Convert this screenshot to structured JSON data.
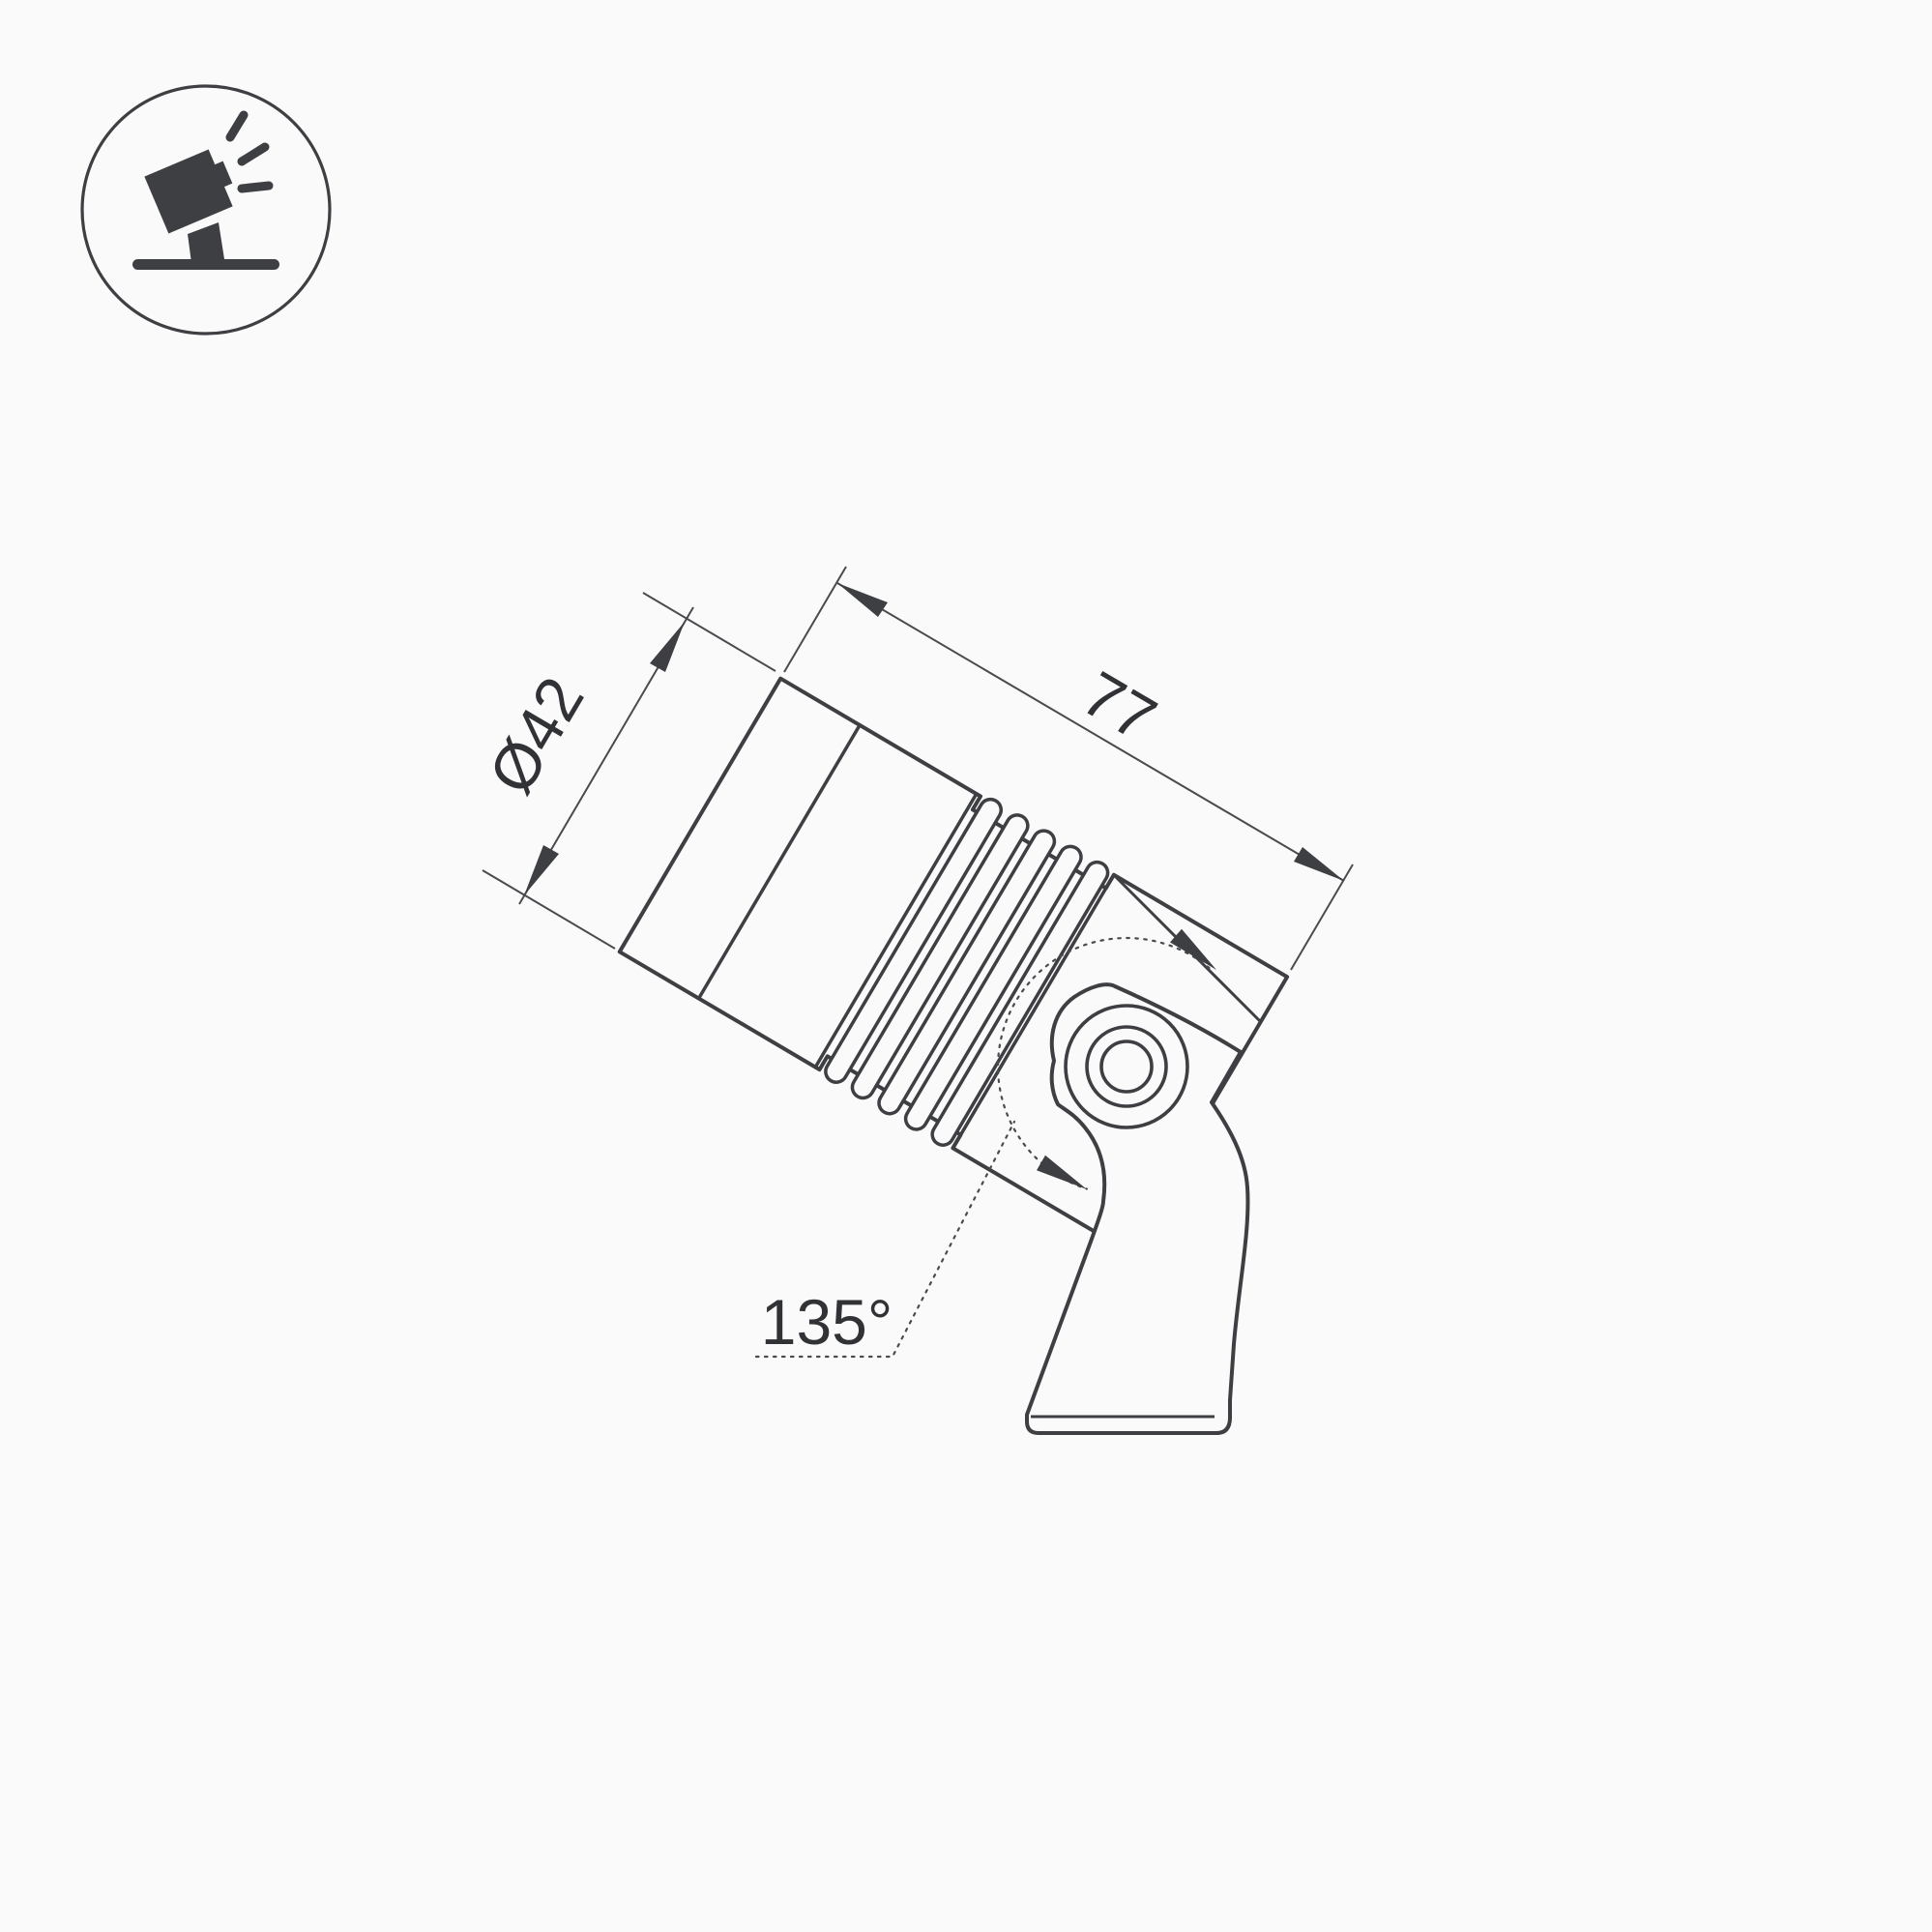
{
  "page": {
    "background_color": "#fafafa",
    "line_color": "#3e3f43",
    "text_color": "#313236",
    "kind": "product technical dimension drawing"
  },
  "corner_icon": {
    "name": "tilt-spotlight-icon"
  },
  "drawing": {
    "subject": "adjustable spotlight on mounting bracket",
    "labels": {
      "diameter": "Ø42",
      "length": "77",
      "rotation_angle": "135°"
    }
  }
}
